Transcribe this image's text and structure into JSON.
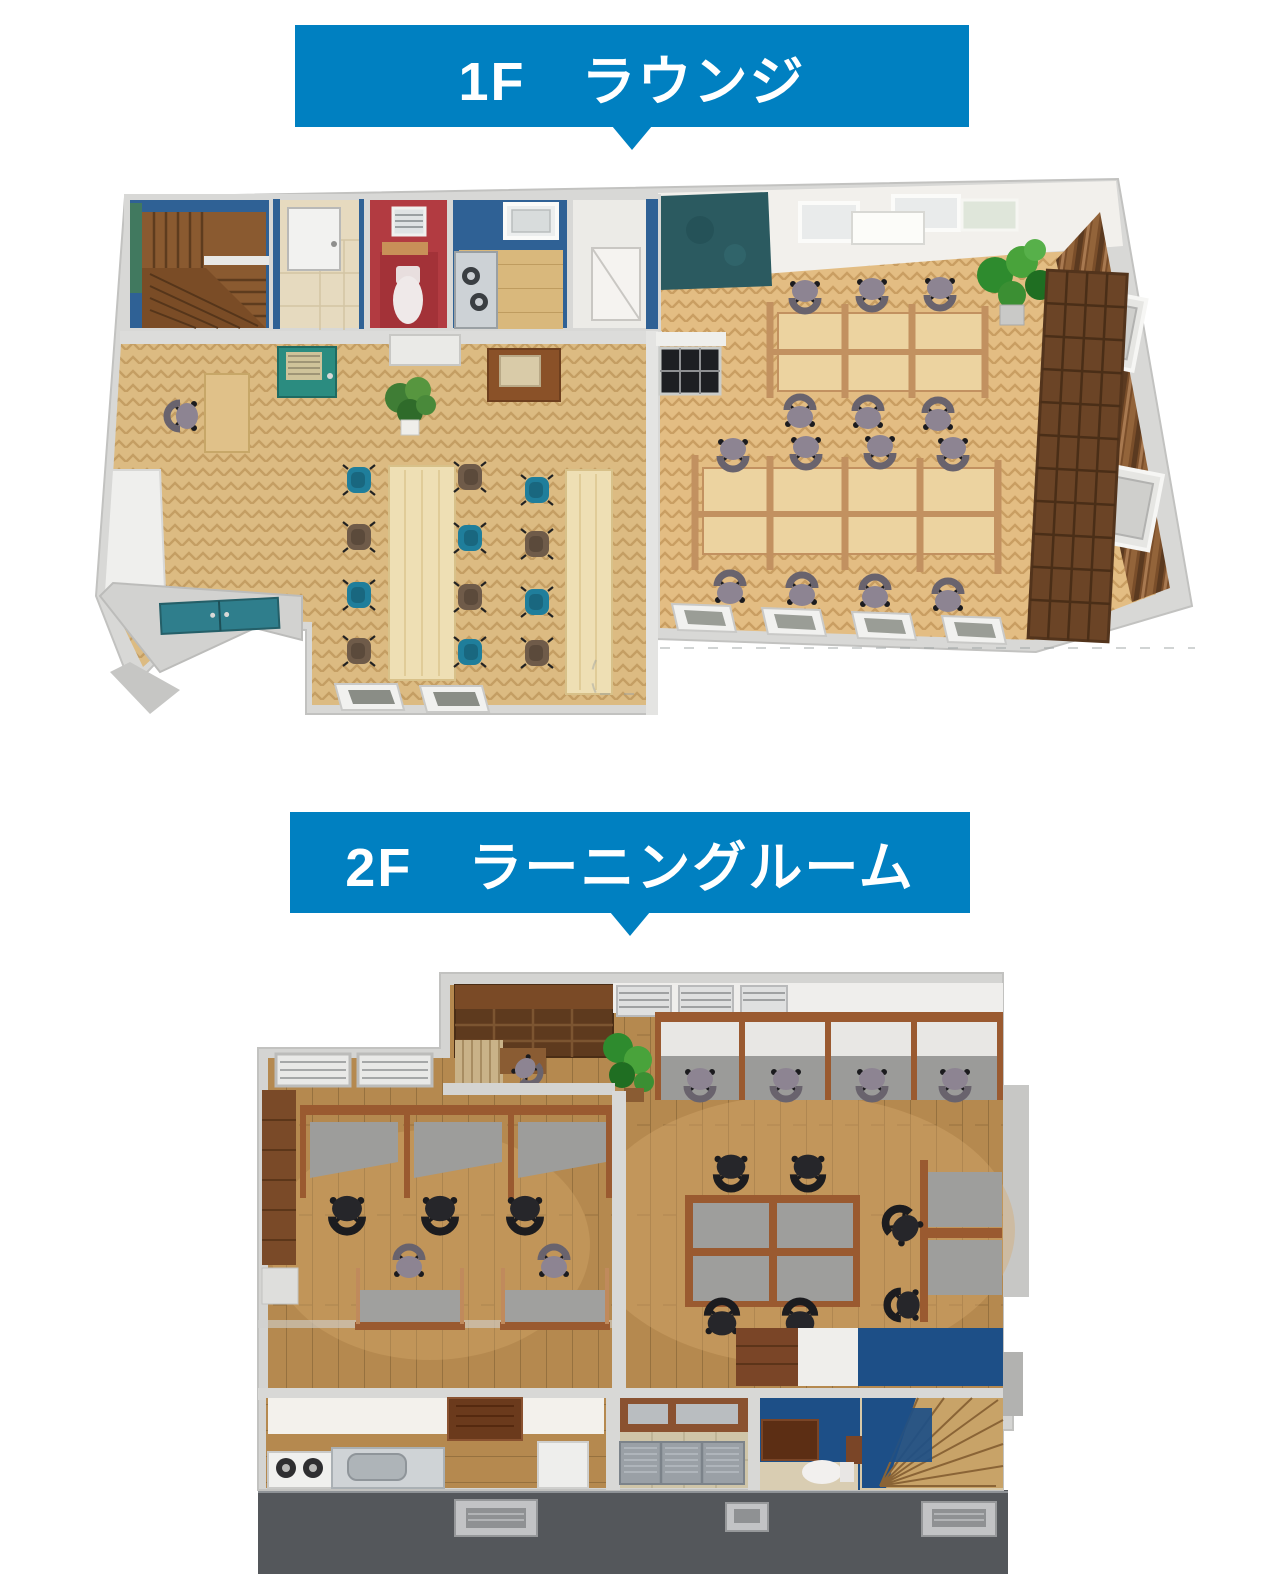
{
  "banners": {
    "accent": "#0080c1",
    "text_color": "#ffffff",
    "floor1": {
      "label": "1F　ラウンジ"
    },
    "floor2": {
      "label": "2F　ラーニングルーム"
    }
  },
  "floorplans": {
    "floor1": {
      "alt": "3D bird's-eye floor plan of the first floor lounge",
      "areas": [
        "staircase",
        "bathroom",
        "toilet",
        "kitchenette",
        "closet",
        "lounge with two long tables",
        "open workspace with partitioned desks",
        "entrance with teal double door",
        "bookshelf and wood slat wall"
      ]
    },
    "floor2": {
      "alt": "3D bird's-eye floor plan of the second floor learning room",
      "areas": [
        "bookshelf corner",
        "window study carrels",
        "partitioned study desks",
        "open desk area",
        "kitchen",
        "lockers",
        "toilet",
        "winding staircase",
        "balcony"
      ]
    }
  },
  "colors": {
    "wall_gray": "#d6d6d4",
    "floor_herringbone_wood": "#dcbb82",
    "floor_plank_wood": "#b5894f",
    "accent_wall_blue": "#2f6195",
    "toilet_wall_red": "#b23b41",
    "door_teal": "#2b8c80",
    "entrance_teal": "#2f7e8c",
    "chair_teal": "#1f7e9b",
    "chair_brown": "#6f5b49",
    "chair_gray": "#8d8492",
    "chair_black": "#26262a",
    "bookshelf_brown": "#6b4426",
    "carrel_frame_brown": "#9a5a30",
    "stair_wood": "#8a5a30",
    "stair_hall_blue": "#1d4f87",
    "balcony_gray": "#54575b"
  }
}
